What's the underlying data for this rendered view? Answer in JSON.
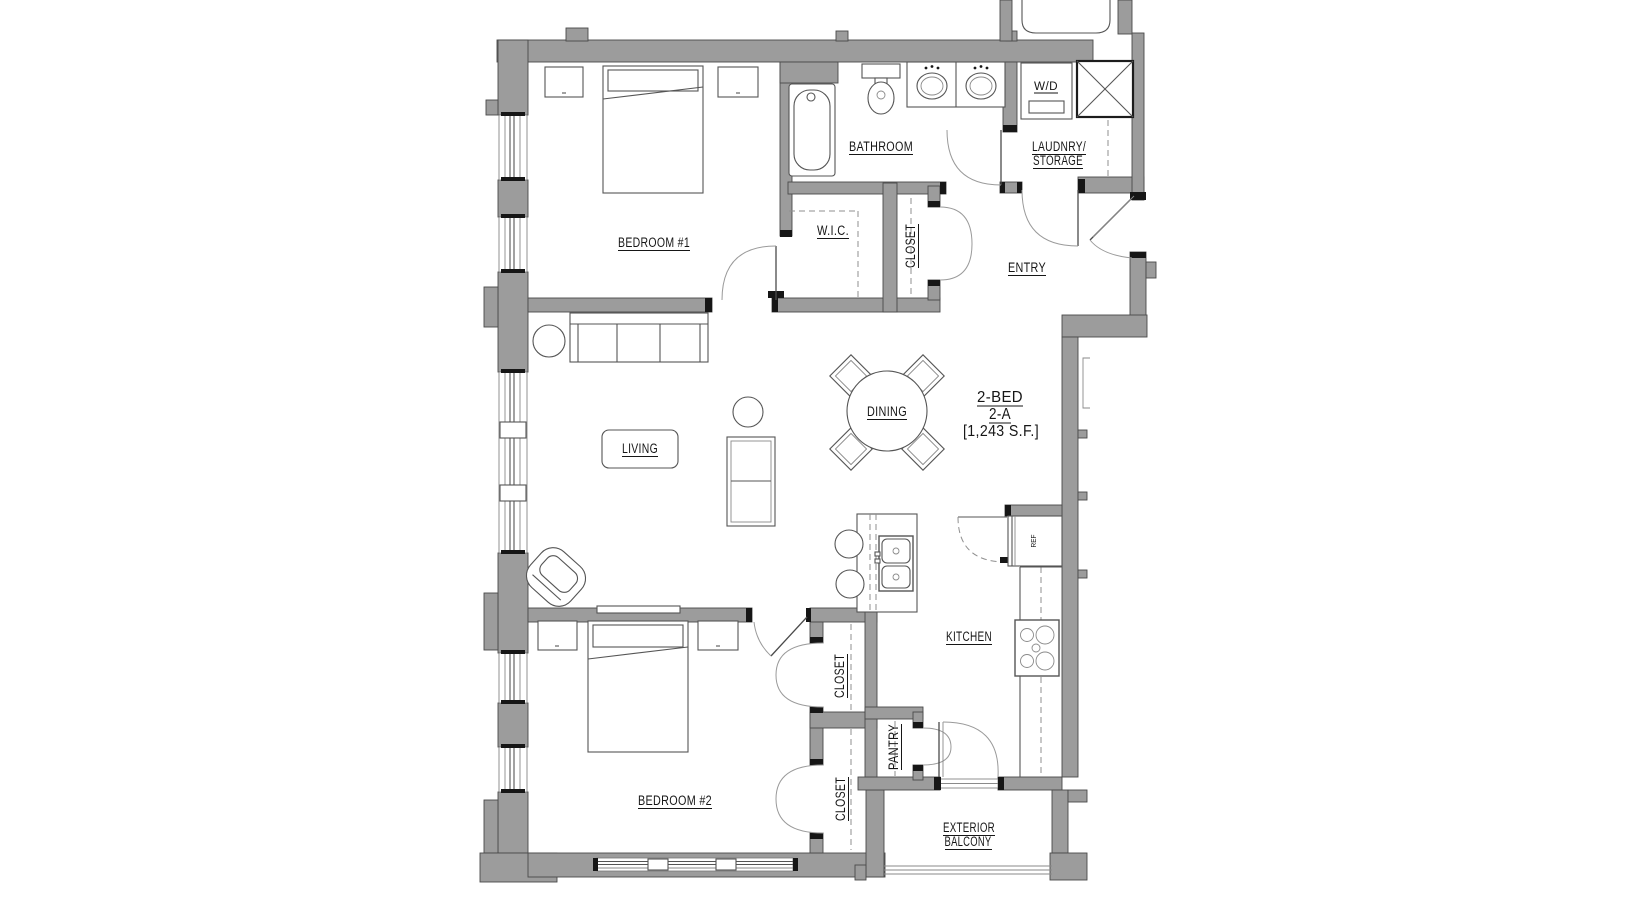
{
  "floor_plan": {
    "unit": {
      "name": "2-BED",
      "variant": "2-A",
      "area": "[1,243 S.F.]"
    },
    "labels": {
      "bathroom": "BATHROOM",
      "laundry_line1": "LAUDNRY/",
      "laundry_line2": "STORAGE",
      "washer_dryer": "W/D",
      "bedroom1": "BEDROOM #1",
      "wic": "W.I.C.",
      "closet_entry": "CLOSET",
      "entry": "ENTRY",
      "dining": "DINING",
      "living": "LIVING",
      "kitchen": "KITCHEN",
      "closet_upper": "CLOSET",
      "closet_lower": "CLOSET",
      "pantry": "PANTRY",
      "bedroom2": "BEDROOM #2",
      "balcony_line1": "EXTERIOR",
      "balcony_line2": "BALCONY",
      "refrigerator": "REF"
    },
    "colors": {
      "background": "#ffffff",
      "wall_fill": "#9c9c9c",
      "wall_stroke": "#4a4a4a",
      "line": "#555555",
      "text": "#161616"
    }
  }
}
